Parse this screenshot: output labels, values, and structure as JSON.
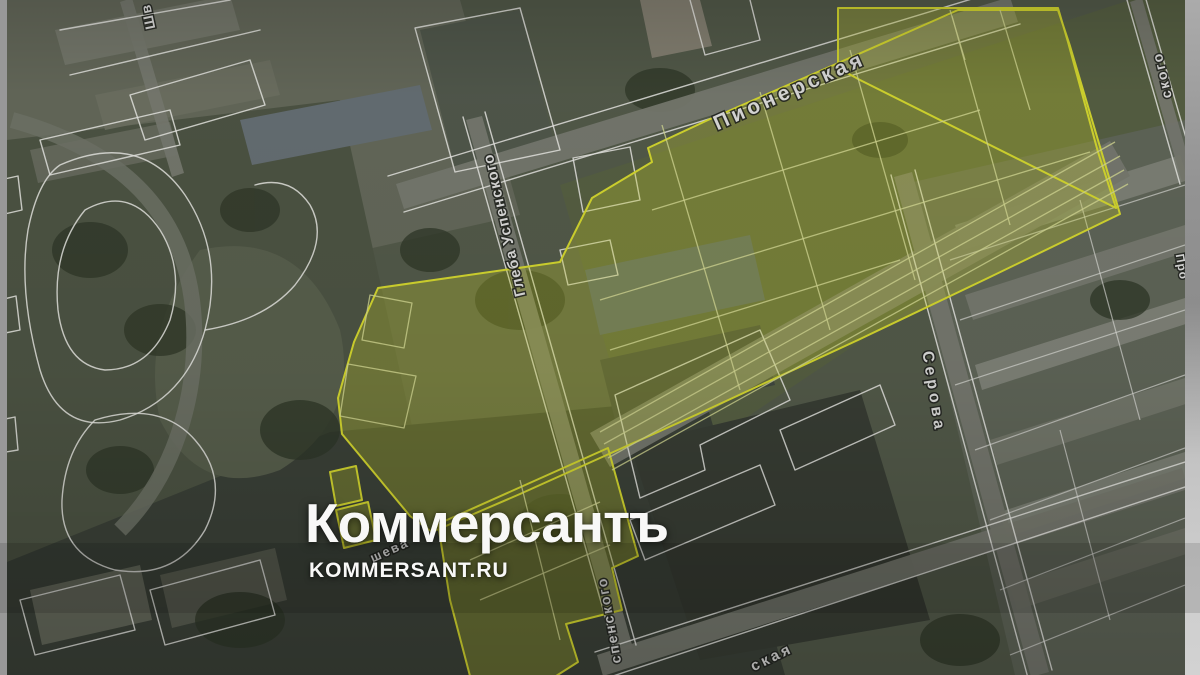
{
  "image": {
    "kind": "news-photo-satellite-cadastral-map",
    "description": "Satellite map with white cadastral parcel boundaries and a yellow highlighted development zone"
  },
  "watermark": {
    "logo_text": "Коммерсантъ",
    "site_text": "KOMMERSANT.RU"
  },
  "map": {
    "street_labels": [
      {
        "id": "pionerskaya",
        "text": "Пионерская"
      },
      {
        "id": "gleba-uspenskogo",
        "text": "Глеба Успенского"
      },
      {
        "id": "serova",
        "text": "Серова"
      },
      {
        "id": "skogo-fragment",
        "text": "ского"
      },
      {
        "id": "spenskogo-fragment",
        "text": "спенского"
      },
      {
        "id": "skaya-fragment",
        "text": "ская"
      },
      {
        "id": "shv-fragment",
        "text": "Шв"
      },
      {
        "id": "sheva-fragment",
        "text": "шева"
      },
      {
        "id": "pro-fragment",
        "text": "Про"
      }
    ]
  },
  "colors": {
    "highlight_stroke": "#e5e832",
    "highlight_fill": "rgba(214,224,44,0.30)",
    "watermark": "#f8f8f7",
    "cadastral_line": "#fafaf6",
    "letterbox_gray": "#9a9a9a"
  }
}
